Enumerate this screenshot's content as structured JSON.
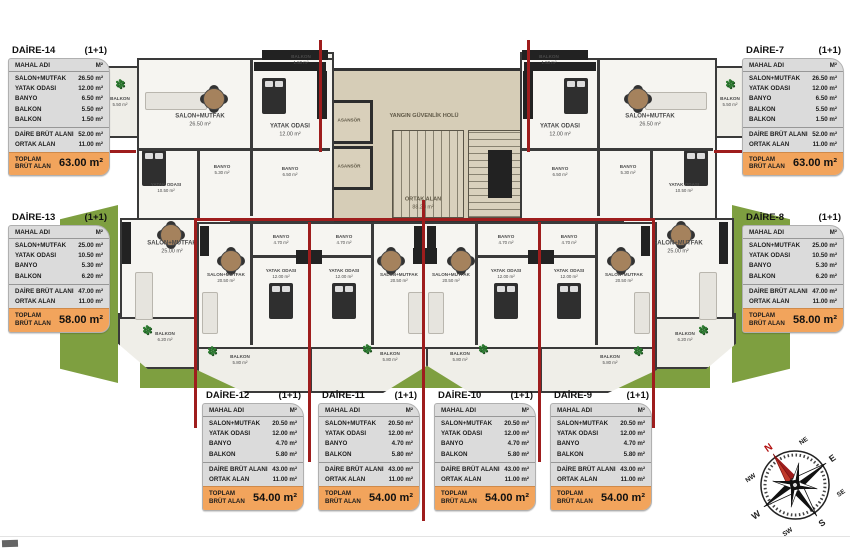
{
  "colors": {
    "red_line": "#9e1d1d",
    "wall": "#3a3a3a",
    "floor_beige": "#d6cdb7",
    "lawn": "#7e9f40",
    "table_bg": "#dbdbdb",
    "table_total_bg": "#f2a45c"
  },
  "tables": [
    {
      "title": "DAİRE-14",
      "type": "(1+1)",
      "header_name": "MAHAL ADI",
      "header_unit": "M²",
      "rooms": [
        [
          "SALON+MUTFAK",
          "26.50 m²"
        ],
        [
          "YATAK ODASI",
          "12.00 m²"
        ],
        [
          "BANYO",
          "6.50 m²"
        ],
        [
          "BALKON",
          "5.50 m²"
        ],
        [
          "BALKON",
          "1.50 m²"
        ]
      ],
      "subtotals": [
        [
          "DAİRE BRÜT ALANI",
          "52.00 m²"
        ],
        [
          "ORTAK ALAN",
          "11.00 m²"
        ]
      ],
      "total_label": "TOPLAM BRÜT ALAN",
      "total": "63.00 m²"
    },
    {
      "title": "DAİRE-7",
      "type": "(1+1)",
      "header_name": "MAHAL ADI",
      "header_unit": "M²",
      "rooms": [
        [
          "SALON+MUTFAK",
          "26.50 m²"
        ],
        [
          "YATAK ODASI",
          "12.00 m²"
        ],
        [
          "BANYO",
          "6.50 m²"
        ],
        [
          "BALKON",
          "5.50 m²"
        ],
        [
          "BALKON",
          "1.50 m²"
        ]
      ],
      "subtotals": [
        [
          "DAİRE BRÜT ALANI",
          "52.00 m²"
        ],
        [
          "ORTAK ALAN",
          "11.00 m²"
        ]
      ],
      "total_label": "TOPLAM BRÜT ALAN",
      "total": "63.00 m²"
    },
    {
      "title": "DAİRE-13",
      "type": "(1+1)",
      "header_name": "MAHAL ADI",
      "header_unit": "M²",
      "rooms": [
        [
          "SALON+MUTFAK",
          "25.00 m²"
        ],
        [
          "YATAK ODASI",
          "10.50 m²"
        ],
        [
          "BANYO",
          "5.30 m²"
        ],
        [
          "BALKON",
          "6.20 m²"
        ]
      ],
      "subtotals": [
        [
          "DAİRE BRÜT ALANI",
          "47.00 m²"
        ],
        [
          "ORTAK ALAN",
          "11.00 m²"
        ]
      ],
      "total_label": "TOPLAM BRÜT ALAN",
      "total": "58.00 m²"
    },
    {
      "title": "DAİRE-8",
      "type": "(1+1)",
      "header_name": "MAHAL ADI",
      "header_unit": "M²",
      "rooms": [
        [
          "SALON+MUTFAK",
          "25.00 m²"
        ],
        [
          "YATAK ODASI",
          "10.50 m²"
        ],
        [
          "BANYO",
          "5.30 m²"
        ],
        [
          "BALKON",
          "6.20 m²"
        ]
      ],
      "subtotals": [
        [
          "DAİRE BRÜT ALANI",
          "47.00 m²"
        ],
        [
          "ORTAK ALAN",
          "11.00 m²"
        ]
      ],
      "total_label": "TOPLAM BRÜT ALAN",
      "total": "58.00 m²"
    },
    {
      "title": "DAİRE-12",
      "type": "(1+1)",
      "header_name": "MAHAL ADI",
      "header_unit": "M²",
      "rooms": [
        [
          "SALON+MUTFAK",
          "20.50 m²"
        ],
        [
          "YATAK ODASI",
          "12.00 m²"
        ],
        [
          "BANYO",
          "4.70 m²"
        ],
        [
          "BALKON",
          "5.80 m²"
        ]
      ],
      "subtotals": [
        [
          "DAİRE BRÜT ALANI",
          "43.00 m²"
        ],
        [
          "ORTAK ALAN",
          "11.00 m²"
        ]
      ],
      "total_label": "TOPLAM BRÜT ALAN",
      "total": "54.00 m²"
    },
    {
      "title": "DAİRE-11",
      "type": "(1+1)",
      "header_name": "MAHAL ADI",
      "header_unit": "M²",
      "rooms": [
        [
          "SALON+MUTFAK",
          "20.50 m²"
        ],
        [
          "YATAK ODASI",
          "12.00 m²"
        ],
        [
          "BANYO",
          "4.70 m²"
        ],
        [
          "BALKON",
          "5.80 m²"
        ]
      ],
      "subtotals": [
        [
          "DAİRE BRÜT ALANI",
          "43.00 m²"
        ],
        [
          "ORTAK ALAN",
          "11.00 m²"
        ]
      ],
      "total_label": "TOPLAM BRÜT ALAN",
      "total": "54.00 m²"
    },
    {
      "title": "DAİRE-10",
      "type": "(1+1)",
      "header_name": "MAHAL ADI",
      "header_unit": "M²",
      "rooms": [
        [
          "SALON+MUTFAK",
          "20.50 m²"
        ],
        [
          "YATAK ODASI",
          "12.00 m²"
        ],
        [
          "BANYO",
          "4.70 m²"
        ],
        [
          "BALKON",
          "5.80 m²"
        ]
      ],
      "subtotals": [
        [
          "DAİRE BRÜT ALANI",
          "43.00 m²"
        ],
        [
          "ORTAK ALAN",
          "11.00 m²"
        ]
      ],
      "total_label": "TOPLAM BRÜT ALAN",
      "total": "54.00 m²"
    },
    {
      "title": "DAİRE-9",
      "type": "(1+1)",
      "header_name": "MAHAL ADI",
      "header_unit": "M²",
      "rooms": [
        [
          "SALON+MUTFAK",
          "20.50 m²"
        ],
        [
          "YATAK ODASI",
          "12.00 m²"
        ],
        [
          "BANYO",
          "4.70 m²"
        ],
        [
          "BALKON",
          "5.80 m²"
        ]
      ],
      "subtotals": [
        [
          "DAİRE BRÜT ALANI",
          "43.00 m²"
        ],
        [
          "ORTAK ALAN",
          "11.00 m²"
        ]
      ],
      "total_label": "TOPLAM BRÜT ALAN",
      "total": "54.00 m²"
    }
  ],
  "plan": {
    "core": {
      "hall_label": "YANGIN GÜVENLİK HOLÜ",
      "elevator_label": "ASANSÖR",
      "common_label": "ORTAK ALAN",
      "common_area": "88.20 m²"
    },
    "rooms": [
      {
        "name": "BALKON",
        "area": "5.50 m²"
      },
      {
        "name": "SALON+MUTFAK",
        "area": "26.50 m²"
      },
      {
        "name": "YATAK ODASI",
        "area": "12.00 m²"
      },
      {
        "name": "BALKON",
        "area": "1.50 m²"
      },
      {
        "name": "BANYO",
        "area": "5.30 m²"
      },
      {
        "name": "BANYO",
        "area": "6.50 m²"
      },
      {
        "name": "YATAK ODASI",
        "area": "10.50 m²"
      },
      {
        "name": "SALON+MUTFAK",
        "area": "25.00 m²"
      },
      {
        "name": "BALKON",
        "area": "6.20 m²"
      },
      {
        "name": "BALKON",
        "area": "5.50 m²"
      },
      {
        "name": "SALON+MUTFAK",
        "area": "26.50 m²"
      },
      {
        "name": "YATAK ODASI",
        "area": "12.00 m²"
      },
      {
        "name": "BALKON",
        "area": "1.50 m²"
      },
      {
        "name": "BANYO",
        "area": "5.30 m²"
      },
      {
        "name": "BANYO",
        "area": "6.50 m²"
      },
      {
        "name": "YATAK ODASI",
        "area": "10.50 m²"
      },
      {
        "name": "SALON+MUTFAK",
        "area": "25.00 m²"
      },
      {
        "name": "BALKON",
        "area": "6.20 m²"
      },
      {
        "name": "BANYO",
        "area": "4.70 m²"
      },
      {
        "name": "SALON+MUTFAK",
        "area": "20.50 m²"
      },
      {
        "name": "YATAK ODASI",
        "area": "12.00 m²"
      },
      {
        "name": "BALKON",
        "area": "5.80 m²"
      },
      {
        "name": "BANYO",
        "area": "4.70 m²"
      },
      {
        "name": "SALON+MUTFAK",
        "area": "20.50 m²"
      },
      {
        "name": "YATAK ODASI",
        "area": "12.00 m²"
      },
      {
        "name": "BALKON",
        "area": "5.80 m²"
      },
      {
        "name": "BANYO",
        "area": "4.70 m²"
      },
      {
        "name": "SALON+MUTFAK",
        "area": "20.50 m²"
      },
      {
        "name": "YATAK ODASI",
        "area": "12.00 m²"
      },
      {
        "name": "BALKON",
        "area": "5.80 m²"
      },
      {
        "name": "BANYO",
        "area": "4.70 m²"
      },
      {
        "name": "SALON+MUTFAK",
        "area": "20.50 m²"
      },
      {
        "name": "YATAK ODASI",
        "area": "12.00 m²"
      },
      {
        "name": "BALKON",
        "area": "5.80 m²"
      }
    ]
  },
  "compass": {
    "points": [
      "N",
      "NE",
      "E",
      "SE",
      "S",
      "SW",
      "W",
      "NW"
    ]
  }
}
